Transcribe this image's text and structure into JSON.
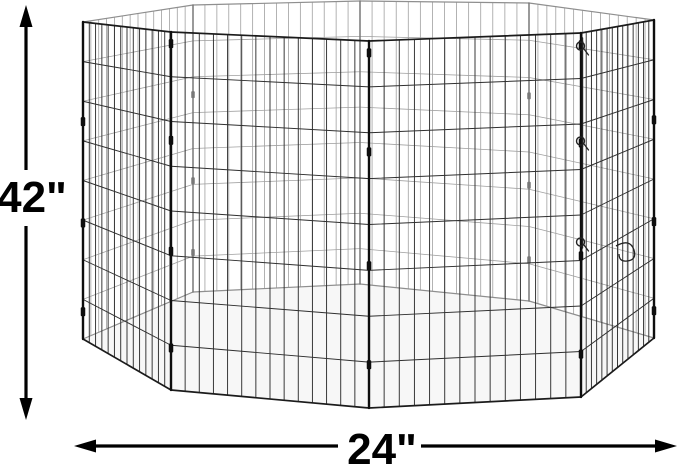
{
  "diagram": {
    "type": "product-dimension-diagram",
    "subject": "octagonal 8-panel wire pet exercise pen",
    "panel_count": 8,
    "height_dimension": {
      "label": "42\"",
      "value": 42,
      "unit": "in"
    },
    "width_dimension": {
      "label": "24\"",
      "value": 24,
      "unit": "in"
    }
  },
  "colors": {
    "background": "#ffffff",
    "dimension_lines": "#000000",
    "wire_front": "#2f2f2f",
    "rail_front": "#1b1b1b",
    "post_front": "#0e0e0e",
    "wire_back": "#a0a0a0",
    "rail_back": "#8f8f8f",
    "post_back": "#787878",
    "floor_tint": "rgba(0,0,0,0.03)",
    "latch": "#222222"
  }
}
